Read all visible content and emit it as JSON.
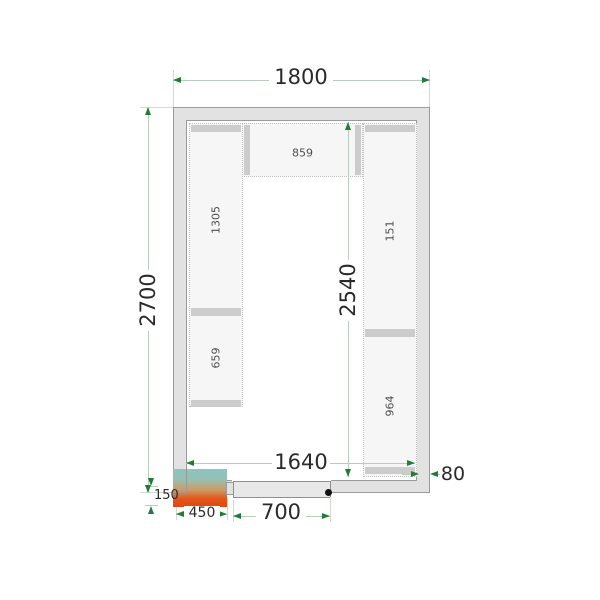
{
  "diagram": {
    "kind": "cold-room-floor-plan",
    "dimensions_mm": {
      "outer_width": "1800",
      "outer_depth": "2700",
      "inner_depth": "2540",
      "inner_width": "1640",
      "wall_thickness": "80",
      "unit_protrusion": "150",
      "unit_width": "450",
      "door_width": "700"
    },
    "shelf_labels": {
      "left_upper": "1305",
      "left_lower": "659",
      "top_shelf": "859",
      "right_upper": "151",
      "right_lower": "964"
    },
    "colors": {
      "wall_fill": "#e2e2e2",
      "wall_border": "#9a9a9a",
      "shelf_fill": "#f6f6f6",
      "shelf_bar": "#cccccc",
      "dim_line": "#b9cdbb",
      "dim_arrow": "#1f7d35",
      "cooler_top": "#8cc4c0",
      "cooler_bottom": "#e1470e",
      "door_fill": "#e8e8e8",
      "door_handle": "#121212"
    }
  }
}
